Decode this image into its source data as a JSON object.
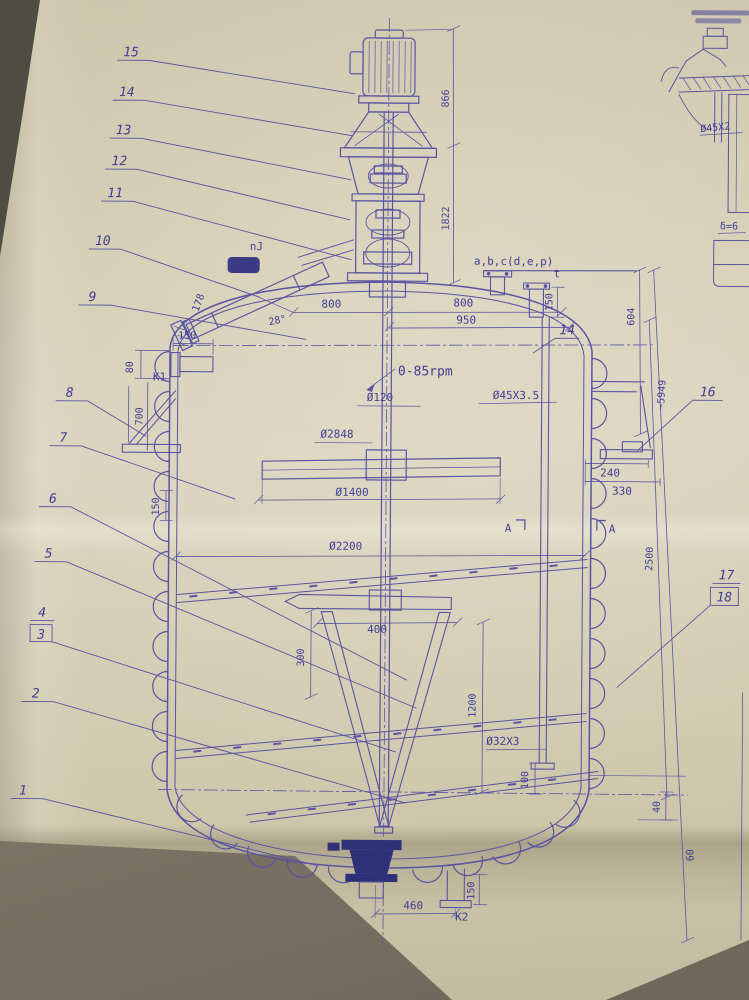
{
  "document": {
    "type": "engineering-drawing-photo",
    "subject": "agitated reactor vessel with half-coil jacket, general assembly section view"
  },
  "colors": {
    "ink": "#5a54a2",
    "ink_dark": "#2e3178",
    "paper": "#d5ceb5",
    "table": "#8a8476"
  },
  "labels": {
    "rpm": "0-85rpm",
    "shaft_dia": "Ø120",
    "vessel_od": "Ø2848",
    "coil_pipe": "Ø45X3.5",
    "impeller_dia": "Ø1400",
    "inner_dia": "Ø2200",
    "dip_pipe": "Ø32X3",
    "nozzle_group": "a,b,c(d,e,p)",
    "nozzle_t": "t",
    "k1": "K1",
    "k2": "K2",
    "nj": "nJ",
    "angle28": "28°",
    "section_a_left": "A",
    "section_a_right": "A",
    "detail_pipe": "Ø45X2",
    "detail_thk": "δ=6"
  },
  "dims": {
    "d866": "866",
    "d1822": "1822",
    "d604": "604",
    "d150_top": "150",
    "d800l": "800",
    "d800r": "800",
    "d950": "950",
    "d178": "178",
    "d150_k1": "150",
    "d80": "80",
    "d700": "700",
    "d240": "240",
    "d330": "330",
    "d5949": "~5949",
    "d2500": "2500",
    "d150_coil": "150",
    "d400": "400",
    "d300": "300",
    "d1200": "1200",
    "d100": "100",
    "d40": "40",
    "d60": "60",
    "d460": "460",
    "d150_k2": "150"
  },
  "callouts": {
    "c1": "1",
    "c2": "2",
    "c3": "3",
    "c4": "4",
    "c5": "5",
    "c6": "6",
    "c7": "7",
    "c8": "8",
    "c9": "9",
    "c10": "10",
    "c11": "11",
    "c12": "12",
    "c13": "13",
    "c14": "14",
    "c15": "15",
    "c16": "16",
    "c17": "17",
    "c18": "18",
    "c14b": "14"
  }
}
